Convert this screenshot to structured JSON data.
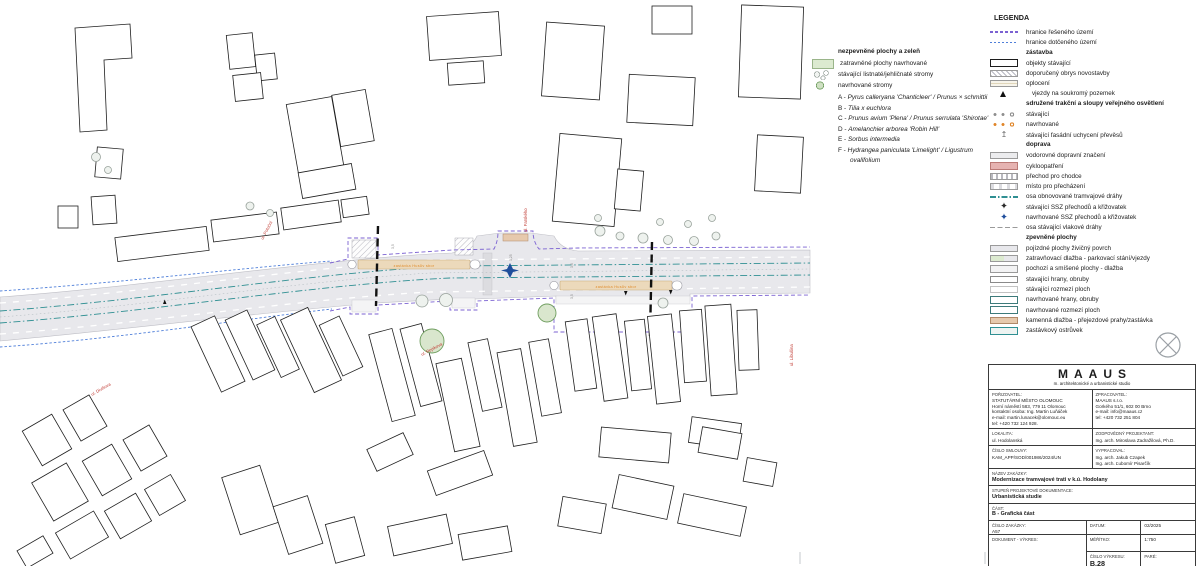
{
  "plant_legend": {
    "title": "nezpevněné plochy a zeleň",
    "rows": [
      {
        "swatch": "grass",
        "label": "zatravněné plochy navrhované"
      },
      {
        "swatch": "existing-trees",
        "label": "stávající listnaté/jehličnaté stromy"
      },
      {
        "swatch": "proposed-tree",
        "label": "navrhované stromy"
      }
    ],
    "species": [
      {
        "key": "A",
        "name": "Pyrus calleryana 'Chanticleer' / Prunus × schmittii"
      },
      {
        "key": "B",
        "name": "Tilia x euchlora"
      },
      {
        "key": "C",
        "name": "Prunus avium 'Plena' / Prunus serrulata 'Shirotae'"
      },
      {
        "key": "D",
        "name": "Amelanchier arborea 'Robin Hill'"
      },
      {
        "key": "E",
        "name": "Sorbus intermedia"
      },
      {
        "key": "F",
        "name": "Hydrangea paniculata 'Limelight' / Ligustrum ovalifolium"
      }
    ]
  },
  "legend": {
    "title": "LEGENDA",
    "rows": [
      {
        "swatch": "line-purple-dash",
        "label": "hranice řešeného území"
      },
      {
        "swatch": "line-blue-dash",
        "label": "hranice dotčeného území"
      },
      {
        "heading": "zástavba"
      },
      {
        "swatch": "rect-existing",
        "label": "objekty stávající"
      },
      {
        "swatch": "rect-hatch",
        "label": "doporučený obrys novostavby"
      },
      {
        "swatch": "rect-fence",
        "label": "oplocení"
      },
      {
        "swatch": "triangle",
        "label": "vjezdy na soukromý pozemek"
      },
      {
        "heading": "sdružené trakční a sloupy veřejného osvětlení"
      },
      {
        "swatch": "dots-gray",
        "label": "stávající"
      },
      {
        "swatch": "dots-orange",
        "label": "navrhované"
      },
      {
        "swatch": "anchor",
        "label": "stávající fasádní uchycení převěsů"
      },
      {
        "heading": "doprava"
      },
      {
        "swatch": "rect-gray",
        "label": "vodorovné dopravní značení"
      },
      {
        "swatch": "rect-pink",
        "label": "cykloopatření"
      },
      {
        "swatch": "rect-crossing",
        "label": "přechod pro chodce"
      },
      {
        "swatch": "rect-crossing2",
        "label": "místo pro přecházení"
      },
      {
        "swatch": "line-tram-axis",
        "label": "osa obnovované tramvajové dráhy"
      },
      {
        "swatch": "ssz-exist",
        "label": "stávající SSZ přechodů a křižovatek"
      },
      {
        "swatch": "ssz-new",
        "label": "navrhované SSZ přechodů a křižovatek"
      },
      {
        "swatch": "line-rail",
        "label": "osa stávající vlakové dráhy"
      },
      {
        "heading": "zpevněné plochy"
      },
      {
        "swatch": "rect-asphalt",
        "label": "pojízdné plochy živičný povrch"
      },
      {
        "swatch": "rect-grasspave",
        "label": "zatravňovací dlažba - parkovací stání/vjezdy"
      },
      {
        "swatch": "rect-paving",
        "label": "pochozí a smíšené plochy - dlažba"
      },
      {
        "swatch": "rect-edge-exist",
        "label": "stavající hrany, obruby"
      },
      {
        "swatch": "rect-bound-exist",
        "label": "stávající rozmezí ploch"
      },
      {
        "swatch": "rect-edge-new",
        "label": "navrhované hrany, obruby"
      },
      {
        "swatch": "rect-bound-new",
        "label": "navrhované rozmezí ploch"
      },
      {
        "swatch": "rect-stone",
        "label": "kamenná dlažba - přejezdové prahy/zastávka"
      },
      {
        "swatch": "rect-island",
        "label": "zastávkový ostrůvek"
      }
    ]
  },
  "map": {
    "street_labels": [
      {
        "text": "ul. Potoční"
      },
      {
        "text": "ul. Farského"
      },
      {
        "text": "ul. Rejskova"
      },
      {
        "text": "ul. Divišova"
      },
      {
        "text": "ul. Libušina"
      }
    ],
    "stop_labels": [
      {
        "text": "zastávka Husův sbor"
      },
      {
        "text": "zastávka Husův sbor"
      }
    ],
    "dimensions": [
      "3,5",
      "3,25",
      "3,5",
      "3,5"
    ],
    "colors": {
      "boundary_purple": "#7b62d2",
      "boundary_blue": "#4f7fd9",
      "tram_axis_teal": "#2f8f92",
      "road_gray": "#e8e8ec",
      "platform_tan": "#ecd9bb",
      "stop_text_orange": "#df8b2b",
      "street_label_red": "#c03a32",
      "proposed_green": "#6f9e5f",
      "ssz_blue": "#1f4e9c"
    }
  },
  "title_block": {
    "studio_name": "MAAUS",
    "studio_subtitle": "m. architektonické a urbanistické studio",
    "porizovatel_label": "POŘIZOVATEL:",
    "porizovatel": "STATUTÁRNÍ MĚSTO OLOMOUC\nHorní náměstí 583, 779 11 Olomouc\nkontaktní osoba: Ing. Martin Luňáček\ne-mail: martin.lunacek@olomouc.eu\ntel: +420 732 124 928.",
    "zpracovatel_label": "ZPRACOVATEL:",
    "zpracovatel": "MAAUS s.r.o.\nGorkého 51/1, 602 00 Brno\ne-mail: info@maaus.cz\ntel: +420 732 251 804",
    "lokalita_label": "LOKALITA:",
    "lokalita": "ul. Hodolanská",
    "projektant_label": "ZODPOVĚDNÝ PROJEKTANT:",
    "projektant": "Ing. arch. Miroslava Zadražilová, Ph.D.",
    "smlouva_label": "ČÍSLO SMLOUVY:",
    "smlouva": "KAM_APP/SOD/001986/2024/UN",
    "vypracoval_label": "VYPRACOVAL:",
    "vypracoval": "Ing. arch. Jakub Czapek\nIng. arch. Ľubomír Pisarčík",
    "nazev_label": "NÁZEV ZAKÁZKY:",
    "nazev": "Modernizace tramvajové trati v k.ú. Hodolany",
    "stupen_label": "STUPEŇ PROJEKTOVÉ DOKUMENTACE:",
    "stupen": "Urbanistická studie",
    "cast_label": "ČÁST:",
    "cast": "B - Grafická část",
    "cislo_zakazky_label": "ČÍSLO ZAKÁZKY:",
    "cislo_zakazky": "A57",
    "datum_label": "DATUM:",
    "datum": "02/2025",
    "dokument_label": "DOKUMENT - VÝKRES:",
    "dokument": "Husův sbor - nový stav",
    "meritko_label": "MĚŘÍTKO:",
    "meritko": "1:750",
    "cislo_vykresu_label": "ČÍSLO VÝKRESU:",
    "cislo_vykresu": "B.28",
    "pare_label": "PARÉ:",
    "pare": ""
  }
}
